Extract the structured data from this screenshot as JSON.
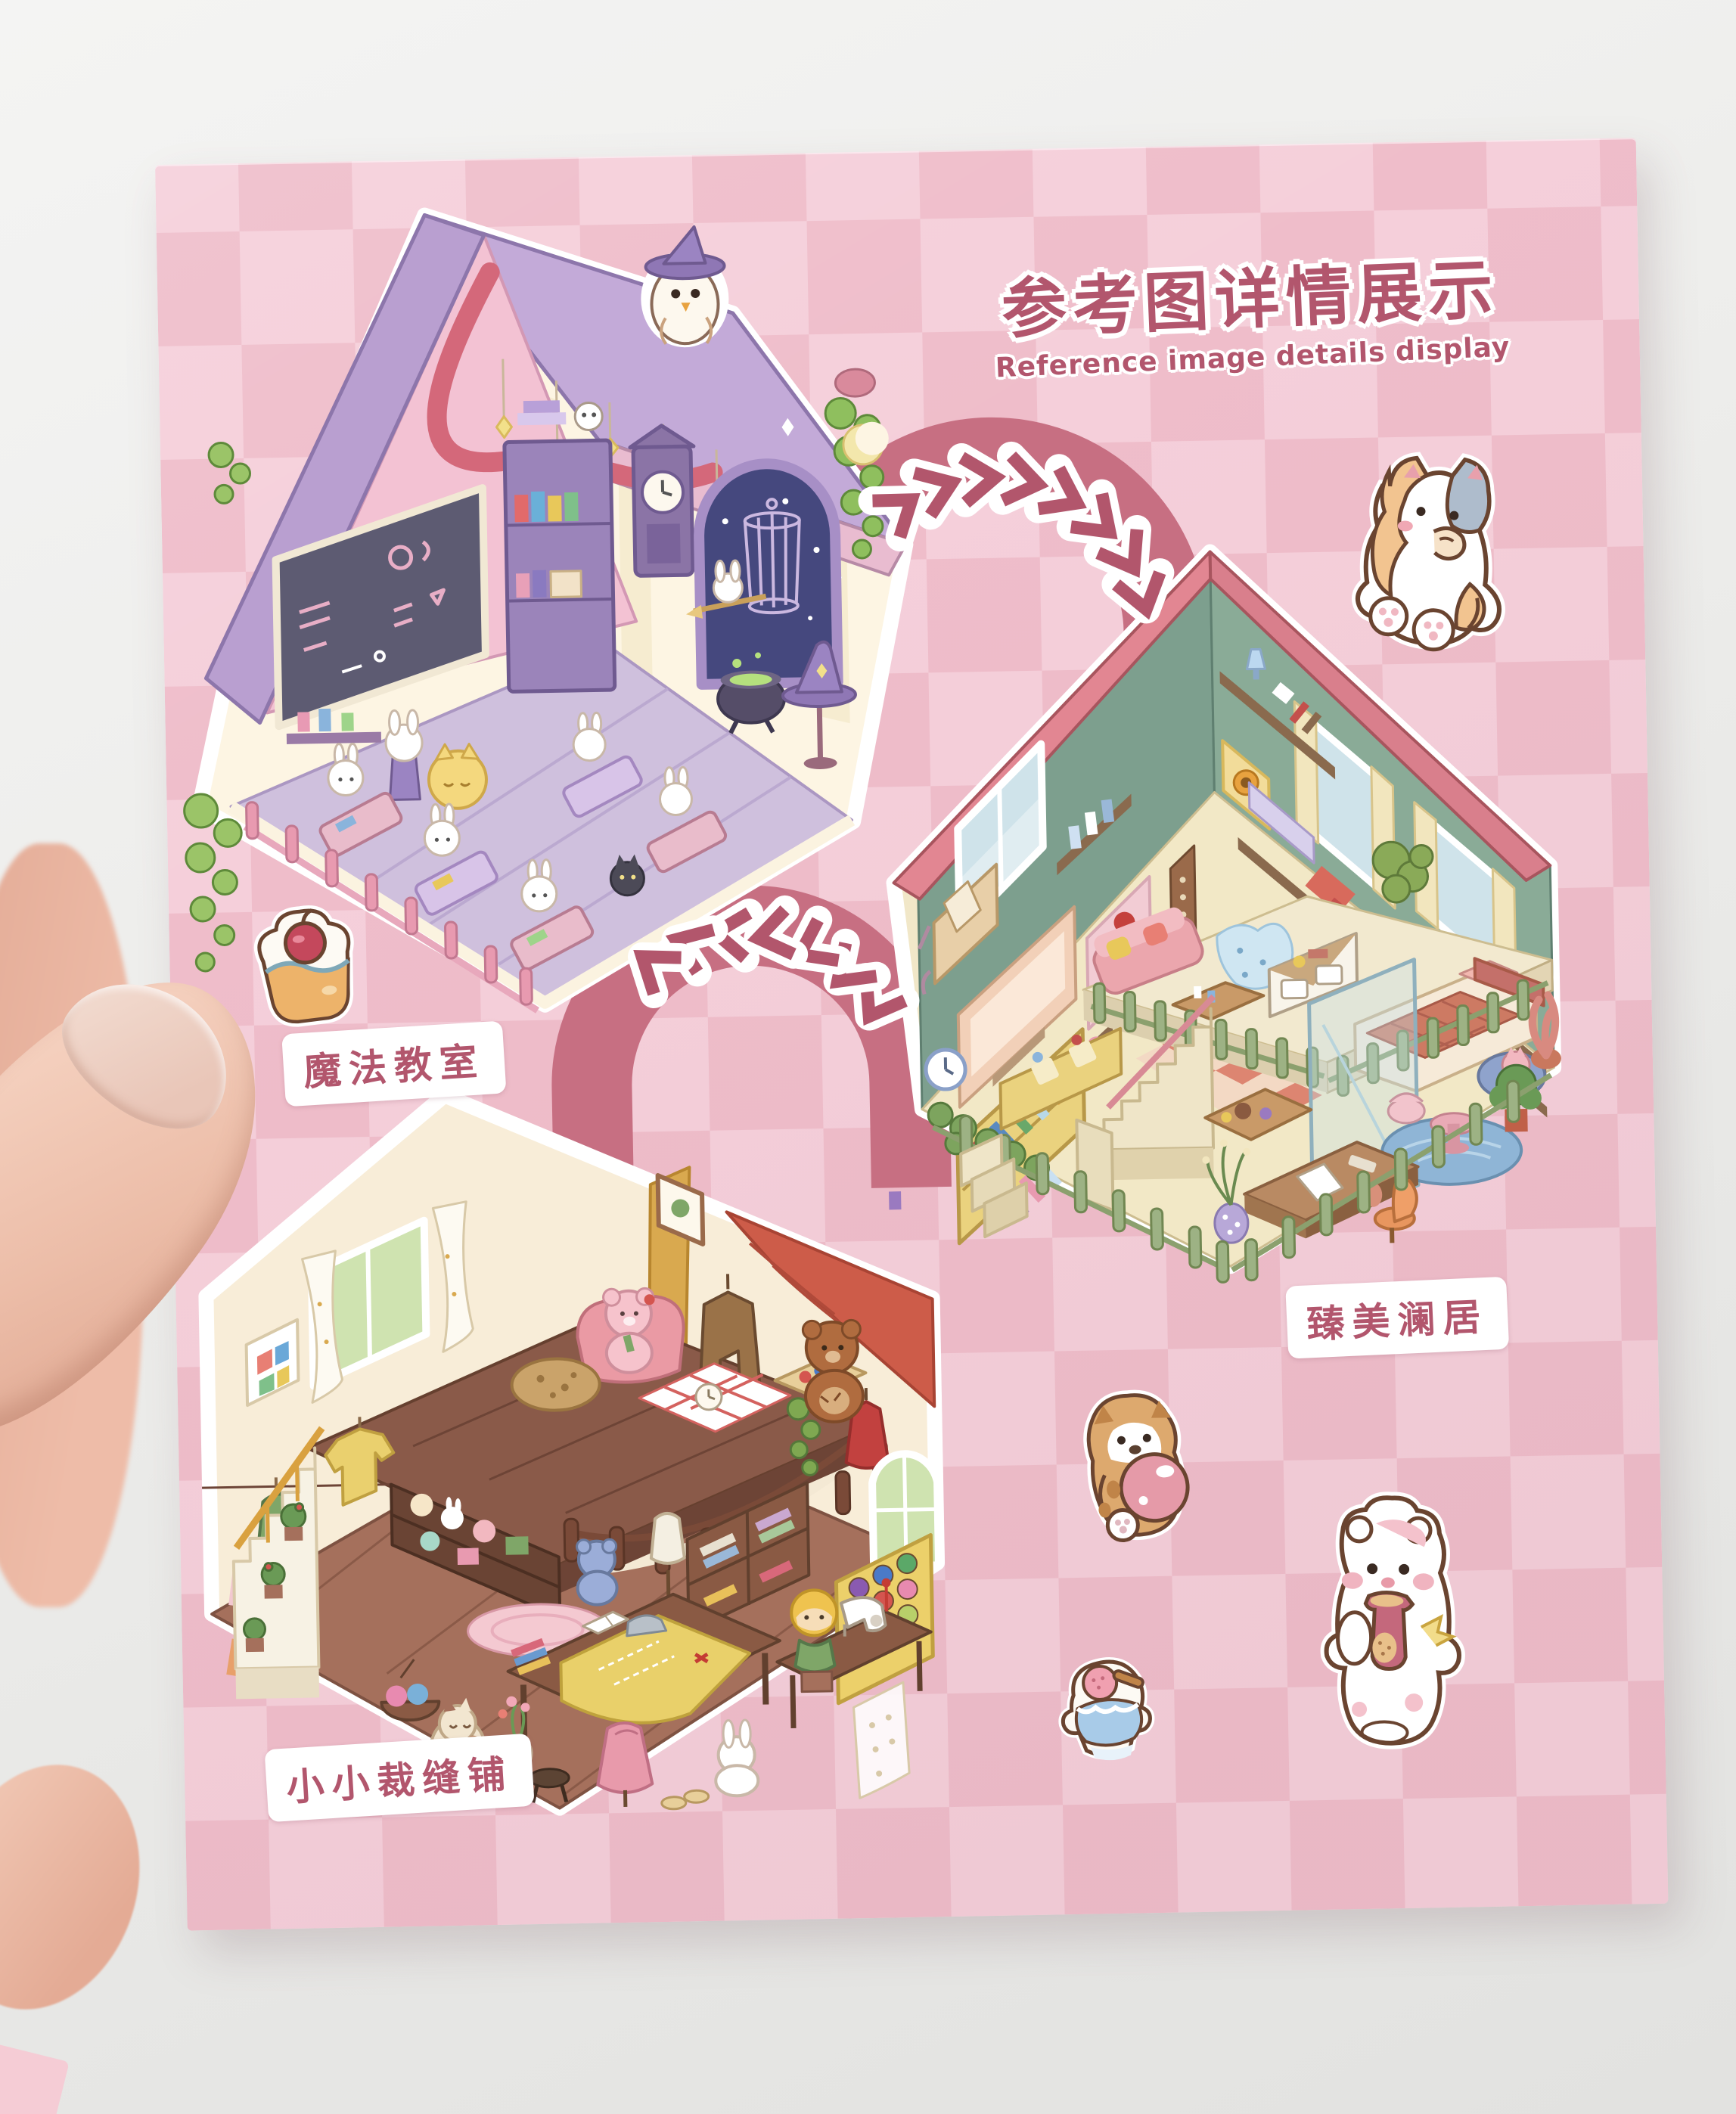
{
  "card": {
    "title_zh": "参考图详情展示",
    "title_en": "Reference image details display",
    "title_color": "#b2566d",
    "checker_light": "#f5cfda",
    "checker_dark": "#efbdca"
  },
  "rooms": [
    {
      "id": "magic-classroom",
      "label_zh": "魔法教室"
    },
    {
      "id": "deluxe-home",
      "label_zh": "臻美澜居"
    },
    {
      "id": "little-tailor-shop",
      "label_zh": "小小裁缝铺"
    }
  ],
  "arrows": {
    "forward_direction": "right",
    "back_direction": "left",
    "ribbon_color": "#c76f82",
    "chevron_color": "#b2566c"
  },
  "stickers": [
    {
      "name": "cupcake-sticker"
    },
    {
      "name": "calico-cat-sticker"
    },
    {
      "name": "puppy-with-ball-sticker"
    },
    {
      "name": "shaved-ice-dessert-sticker"
    },
    {
      "name": "white-bear-with-jar-sticker"
    }
  ]
}
